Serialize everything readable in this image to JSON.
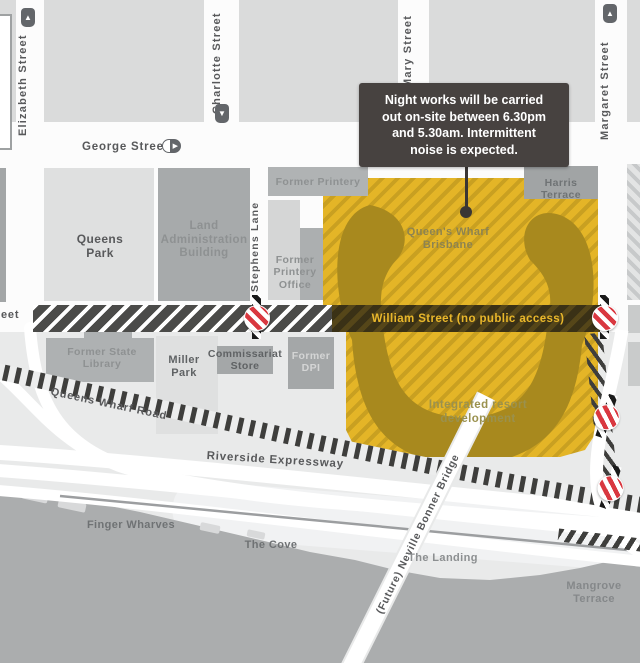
{
  "callout": {
    "text": "Night works will be carried\nout on-site between 6.30pm\nand 5.30am. Intermittent\nnoise is expected."
  },
  "streets": {
    "elizabeth": "Elizabeth Street",
    "charlotte": "Charlotte Street",
    "mary": "Mary Street",
    "margaret": "Margaret Street",
    "george": "George Street",
    "stephens_lane": "Stephens Lane",
    "william_fragment": "eet",
    "william_closed": "William Street (no public access)",
    "queens_wharf_road": "Queens Wharf Road",
    "riverside_expressway": "Riverside Expressway",
    "neville_bonner_bridge": "(Future) Neville Bonner Bridge"
  },
  "places": {
    "queens_park": "Queens\nPark",
    "land_administration_building": "Land\nAdministration\nBuilding",
    "former_printery": "Former Printery",
    "former_printery_office": "Former\nPrintery\nOffice",
    "harris_terrace": "Harris Terrace",
    "queens_wharf_brisbane": "Queen's Wharf\nBrisbane",
    "integrated_resort": "Integrated resort\ndevelopment",
    "former_state_library": "Former State\nLibrary",
    "miller_park": "Miller\nPark",
    "commissariat_store": "Commissariat\nStore",
    "former_dpi": "Former\nDPI",
    "finger_wharves": "Finger Wharves",
    "the_cove": "The Cove",
    "the_landing": "The Landing",
    "mangrove_terrace": "Mangrove\nTerrace"
  },
  "icons": {
    "arrow_up": "▲",
    "arrow_down": "▼",
    "arrow_right": "▶"
  },
  "colors": {
    "night_works_zone": "#E4B527",
    "night_works_hatch": "#C9A021",
    "building_footprint": "#A8891E",
    "closure_band_west": "#4B4B49",
    "closed_street_band": "#3A3116",
    "callout_bg": "#474240",
    "no_entry_red": "#D93840",
    "river": "#ABADAE"
  }
}
